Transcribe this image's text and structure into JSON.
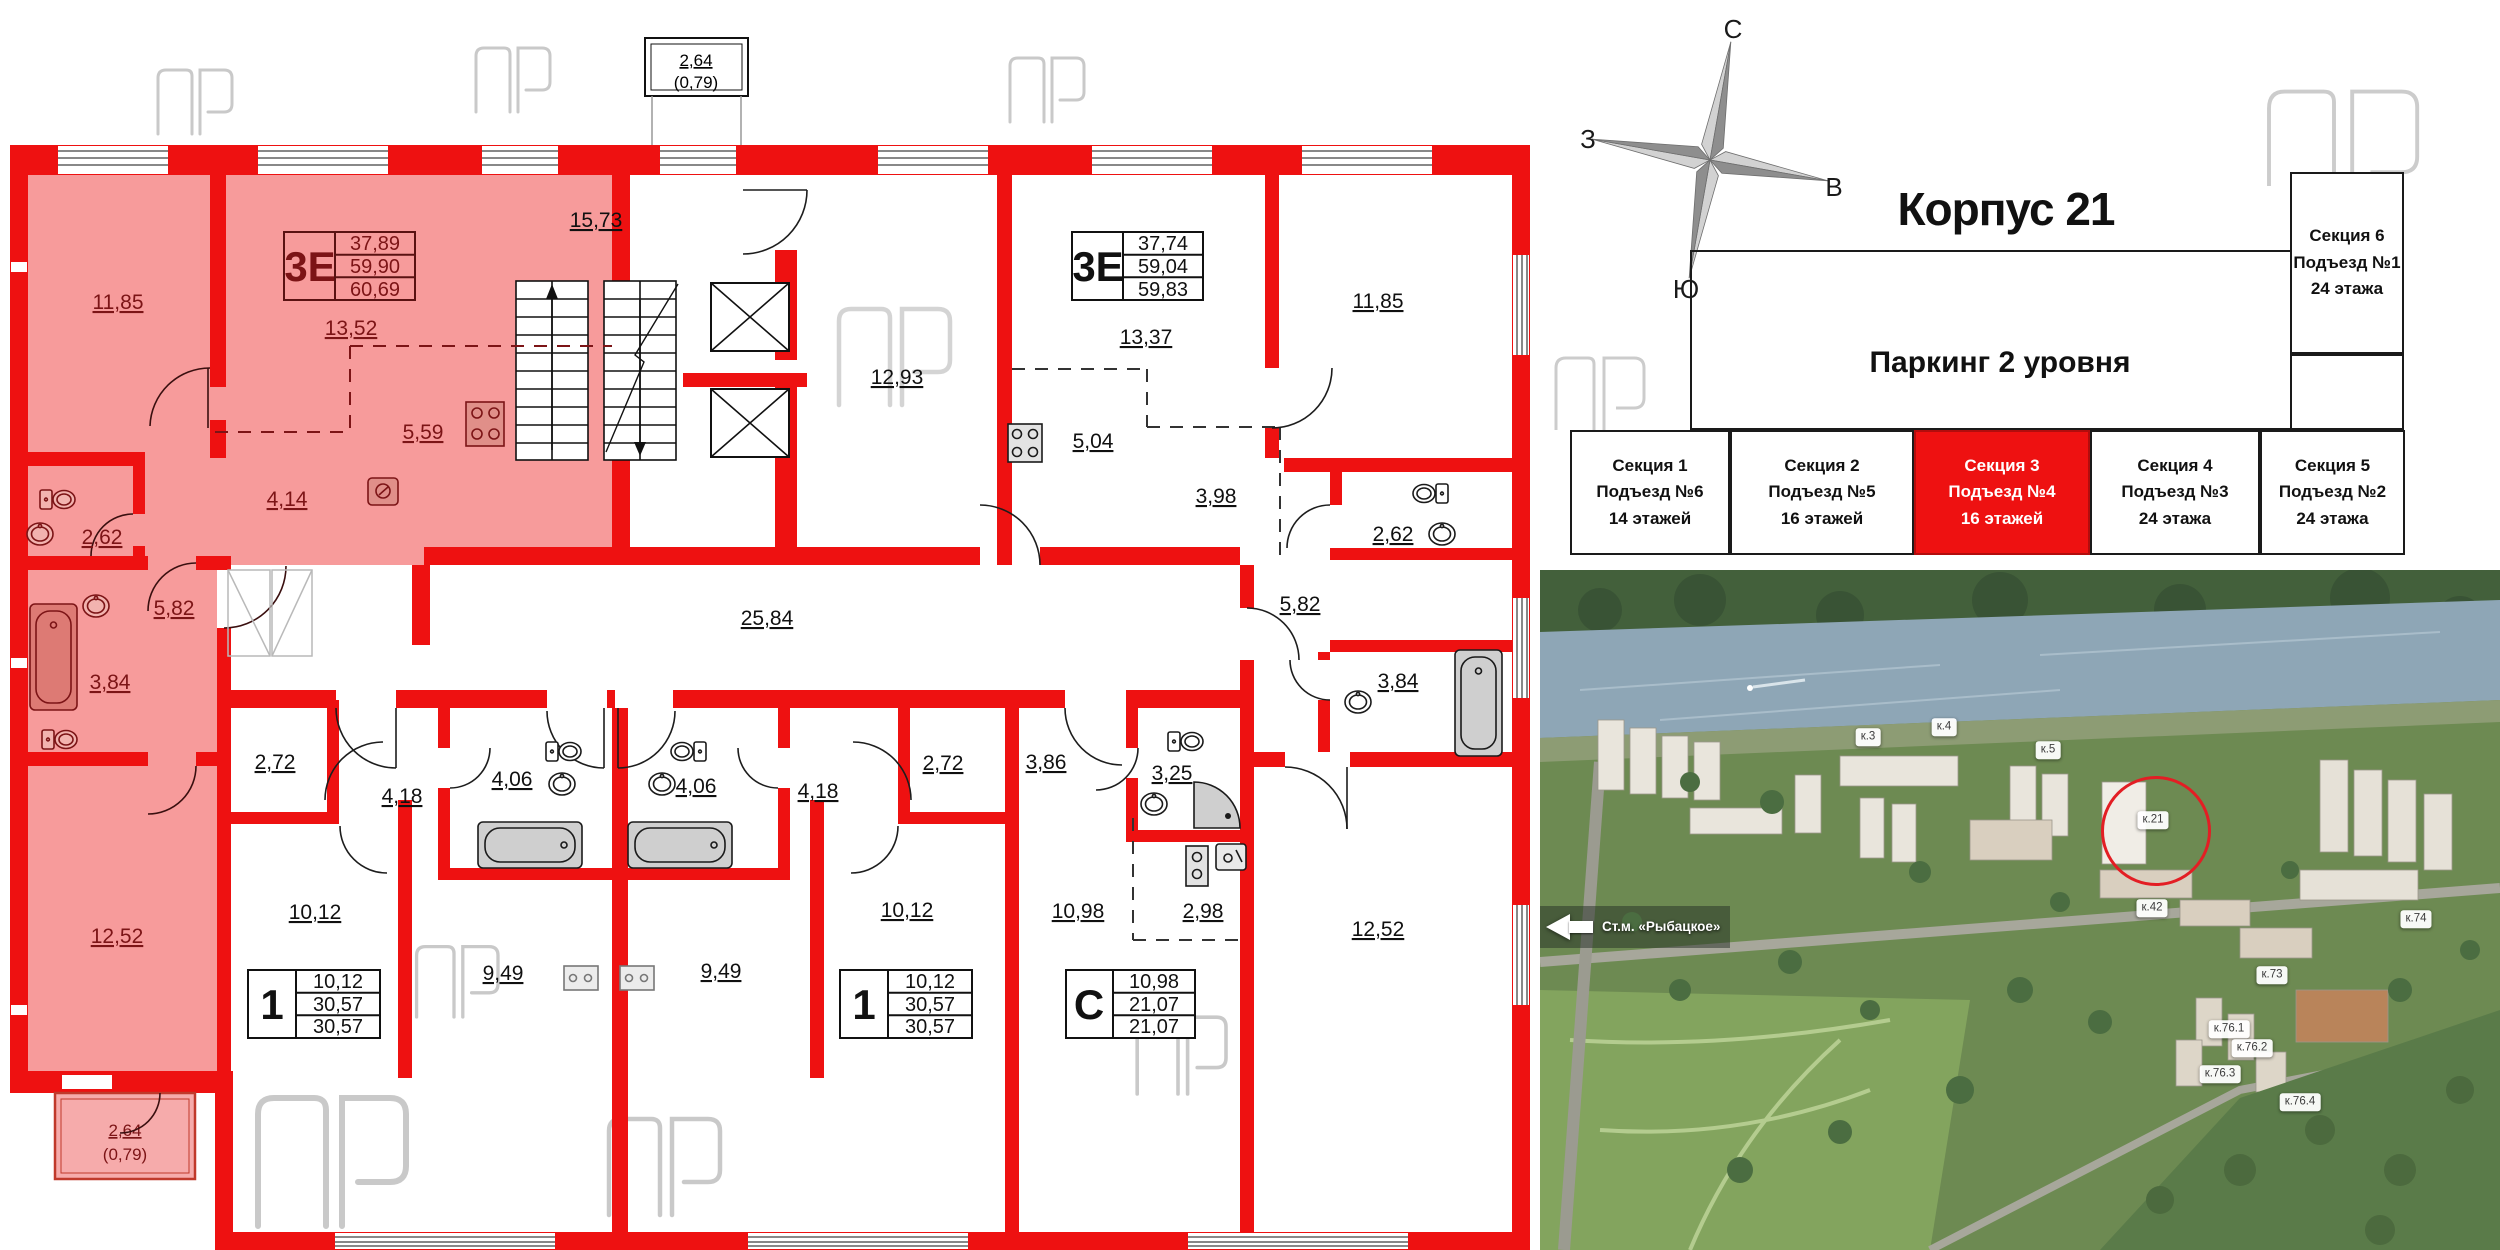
{
  "header": {
    "title": "Корпус 21",
    "parking": "Паркинг 2 уровня"
  },
  "compass": {
    "n": "С",
    "s": "Ю",
    "w": "З",
    "e": "В"
  },
  "sections": [
    {
      "name": "Секция 1",
      "entrance": "Подъезд №6",
      "floors": "14 этажей"
    },
    {
      "name": "Секция 2",
      "entrance": "Подъезд №5",
      "floors": "16 этажей"
    },
    {
      "name": "Секция 3",
      "entrance": "Подъезд №4",
      "floors": "16 этажей"
    },
    {
      "name": "Секция 4",
      "entrance": "Подъезд №3",
      "floors": "24 этажа"
    },
    {
      "name": "Секция 5",
      "entrance": "Подъезд №2",
      "floors": "24 этажа"
    },
    {
      "name": "Секция 6",
      "entrance": "Подъезд №1",
      "floors": "24 этажа"
    }
  ],
  "plan": {
    "stat_boxes": [
      {
        "type": "3Е",
        "values": [
          "37,89",
          "59,90",
          "60,69"
        ]
      },
      {
        "type": "3Е",
        "values": [
          "37,74",
          "59,04",
          "59,83"
        ]
      },
      {
        "type": "1",
        "values": [
          "10,12",
          "30,57",
          "30,57"
        ]
      },
      {
        "type": "1",
        "values": [
          "10,12",
          "30,57",
          "30,57"
        ]
      },
      {
        "type": "С",
        "values": [
          "10,98",
          "21,07",
          "21,07"
        ]
      }
    ],
    "rooms": [
      {
        "area": "11,85"
      },
      {
        "area": "13,52"
      },
      {
        "area": "5,59"
      },
      {
        "area": "4,14"
      },
      {
        "area": "2,62"
      },
      {
        "area": "5,82"
      },
      {
        "area": "3,84"
      },
      {
        "area": "12,52"
      },
      {
        "area": "15,73"
      },
      {
        "area": "12,93"
      },
      {
        "area": "25,84"
      },
      {
        "area": "13,37"
      },
      {
        "area": "5,04"
      },
      {
        "area": "11,85"
      },
      {
        "area": "3,98"
      },
      {
        "area": "2,62"
      },
      {
        "area": "5,82"
      },
      {
        "area": "3,84"
      },
      {
        "area": "12,52"
      },
      {
        "area": "2,72"
      },
      {
        "area": "4,18"
      },
      {
        "area": "4,06"
      },
      {
        "area": "10,12"
      },
      {
        "area": "9,49"
      },
      {
        "area": "4,06"
      },
      {
        "area": "4,18"
      },
      {
        "area": "2,72"
      },
      {
        "area": "9,49"
      },
      {
        "area": "10,12"
      },
      {
        "area": "3,86"
      },
      {
        "area": "3,25"
      },
      {
        "area": "10,98"
      },
      {
        "area": "2,98"
      }
    ],
    "balcony_top": {
      "area": "2,64",
      "coef": "(0,79)"
    },
    "balcony_bottom": {
      "area": "2,64",
      "coef": "(0,79)"
    }
  },
  "map": {
    "labels": [
      {
        "t": "к.3"
      },
      {
        "t": "к.4"
      },
      {
        "t": "к.5"
      },
      {
        "t": "к.21"
      },
      {
        "t": "к.42"
      },
      {
        "t": "к.73"
      },
      {
        "t": "к.74"
      },
      {
        "t": "к.76.1"
      },
      {
        "t": "к.76.2"
      },
      {
        "t": "к.76.3"
      },
      {
        "t": "к.76.4"
      }
    ],
    "metro": "Ст.м. «Рыбацкое»"
  },
  "colors": {
    "wall": "#ee1111",
    "highlight": "#f79b9b",
    "accent": "#e31e24"
  }
}
